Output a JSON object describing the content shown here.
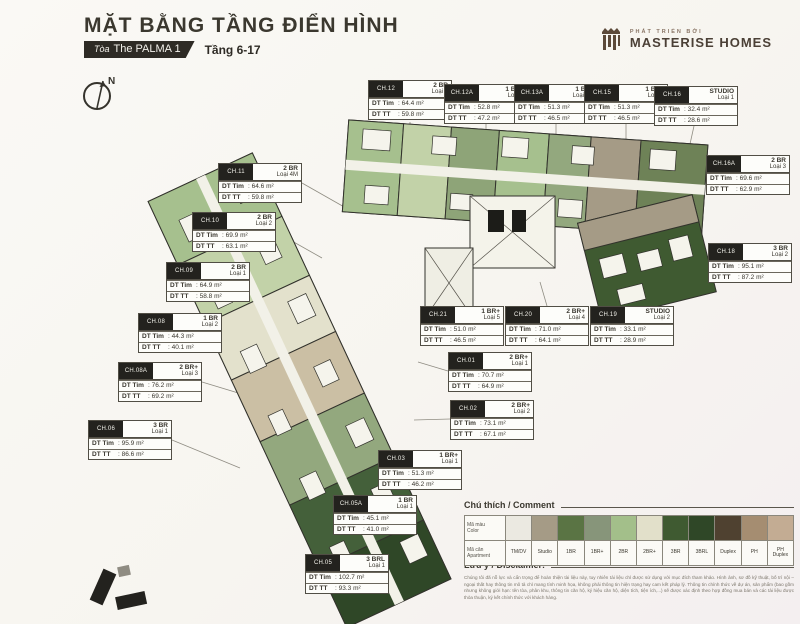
{
  "header": {
    "title": "MẶT BẰNG TẦNG ĐIỂN HÌNH",
    "tower_label": "Tòa",
    "tower_name": "The PALMA 1",
    "floors": "Tầng 6-17"
  },
  "brand": {
    "tagline": "PHÁT TRIỂN BỞI",
    "name": "MASTERISE HOMES"
  },
  "compass": {
    "label": "N"
  },
  "labels": {
    "dt_tim": "DT Tim",
    "dt_tt": "DT TT"
  },
  "units": [
    {
      "code": "CH.12",
      "type": "2 BR",
      "loai": "Loại 4",
      "dt_tim": "64.4 m²",
      "dt_tt": "59.8 m²"
    },
    {
      "code": "CH.12A",
      "type": "1 BR+",
      "loai": "Loại 3",
      "dt_tim": "52.8 m²",
      "dt_tt": "47.2 m²"
    },
    {
      "code": "CH.13A",
      "type": "1 BR+",
      "loai": "Loại 4M",
      "dt_tim": "51.3 m²",
      "dt_tt": "46.5 m²"
    },
    {
      "code": "CH.15",
      "type": "1 BR+",
      "loai": "Loại 4",
      "dt_tim": "51.3 m²",
      "dt_tt": "46.5 m²"
    },
    {
      "code": "CH.16",
      "type": "STUDIO",
      "loai": "Loại 1",
      "dt_tim": "32.4 m²",
      "dt_tt": "28.6 m²"
    },
    {
      "code": "CH.16A",
      "type": "2 BR",
      "loai": "Loại 3",
      "dt_tim": "69.6 m²",
      "dt_tt": "62.9 m²"
    },
    {
      "code": "CH.18",
      "type": "3 BR",
      "loai": "Loại 2",
      "dt_tim": "95.1 m²",
      "dt_tt": "87.2 m²"
    },
    {
      "code": "CH.11",
      "type": "2 BR",
      "loai": "Loại 4M",
      "dt_tim": "64.6 m²",
      "dt_tt": "59.8 m²"
    },
    {
      "code": "CH.10",
      "type": "2 BR",
      "loai": "Loại 2",
      "dt_tim": "69.9 m²",
      "dt_tt": "63.1 m²"
    },
    {
      "code": "CH.09",
      "type": "2 BR",
      "loai": "Loại 1",
      "dt_tim": "64.9 m²",
      "dt_tt": "58.8 m²"
    },
    {
      "code": "CH.08",
      "type": "1 BR",
      "loai": "Loại 2",
      "dt_tim": "44.3 m²",
      "dt_tt": "40.1 m²"
    },
    {
      "code": "CH.08A",
      "type": "2 BR+",
      "loai": "Loại 3",
      "dt_tim": "76.2 m²",
      "dt_tt": "69.2 m²"
    },
    {
      "code": "CH.06",
      "type": "3 BR",
      "loai": "Loại 1",
      "dt_tim": "95.9 m²",
      "dt_tt": "86.6 m²"
    },
    {
      "code": "CH.21",
      "type": "1 BR+",
      "loai": "Loại 5",
      "dt_tim": "51.0 m²",
      "dt_tt": "46.5 m²"
    },
    {
      "code": "CH.20",
      "type": "2 BR+",
      "loai": "Loại 4",
      "dt_tim": "71.0 m²",
      "dt_tt": "64.1 m²"
    },
    {
      "code": "CH.19",
      "type": "STUDIO",
      "loai": "Loại 2",
      "dt_tim": "33.1 m²",
      "dt_tt": "28.9 m²"
    },
    {
      "code": "CH.01",
      "type": "2 BR+",
      "loai": "Loại 1",
      "dt_tim": "70.7 m²",
      "dt_tt": "64.9 m²"
    },
    {
      "code": "CH.02",
      "type": "2 BR+",
      "loai": "Loại 2",
      "dt_tim": "73.1 m²",
      "dt_tt": "67.1 m²"
    },
    {
      "code": "CH.03",
      "type": "1 BR+",
      "loai": "Loại 1",
      "dt_tim": "51.3 m²",
      "dt_tt": "46.2 m²"
    },
    {
      "code": "CH.05A",
      "type": "1 BR",
      "loai": "Loại 1",
      "dt_tim": "45.1 m²",
      "dt_tt": "41.0 m²"
    },
    {
      "code": "CH.05",
      "type": "3 BRL",
      "loai": "Loại 1",
      "dt_tim": "102.7 m²",
      "dt_tt": "93.3 m²"
    }
  ],
  "legend": {
    "title": "Chú thích / Comment",
    "color_row_label_vi": "Mã màu",
    "color_row_label_en": "Color",
    "apt_row_label_vi": "Mã căn",
    "apt_row_label_en": "Apartment",
    "items": [
      {
        "label": "TM/DV",
        "color": "#ebe9e1"
      },
      {
        "label": "Studio",
        "color": "#a59b86"
      },
      {
        "label": "1BR",
        "color": "#5a7444"
      },
      {
        "label": "1BR+",
        "color": "#87957a"
      },
      {
        "label": "2BR",
        "color": "#a3bf8a"
      },
      {
        "label": "2BR+",
        "color": "#e2e0ca"
      },
      {
        "label": "3BR",
        "color": "#3f5a31"
      },
      {
        "label": "3BRL",
        "color": "#2f4727"
      },
      {
        "label": "Duplex",
        "color": "#4f4130"
      },
      {
        "label": "PH",
        "color": "#a58d71"
      },
      {
        "label": "PH Duplex",
        "color": "#c3ac93"
      }
    ],
    "notes": [
      {
        "vi": "Diện Tích Tim Tường : DT Tim",
        "en": "Built-up Area"
      },
      {
        "vi": "Diện Tích Thông Thủy : DT TT",
        "en": "Carpet Area"
      }
    ]
  },
  "disclaimer": {
    "title": "Lưu ý / Disclaimer:",
    "text": "Chúng tôi đã nỗ lực và cẩn trọng để hoàn thiện tài liệu này, tuy nhiên tài liệu chỉ được sử dụng với mục đích tham khảo. Hình ảnh, sơ đồ kỹ thuật, bố trí nội – ngoại thất hay thông tin mô tả chỉ mang tính minh họa, không phải thông tin hiện trạng hay cam kết pháp lý. Thông tin chính thức về dự án, sản phẩm (bao gồm nhưng không giới hạn: tên tòa, phân khu, thông tin căn hộ, ký hiệu căn hộ, diện tích, tiện ích,...) sẽ được xác định theo hợp đồng mua bán và các tài liệu được thỏa thuận, ký kết chính thức với khách hàng."
  }
}
